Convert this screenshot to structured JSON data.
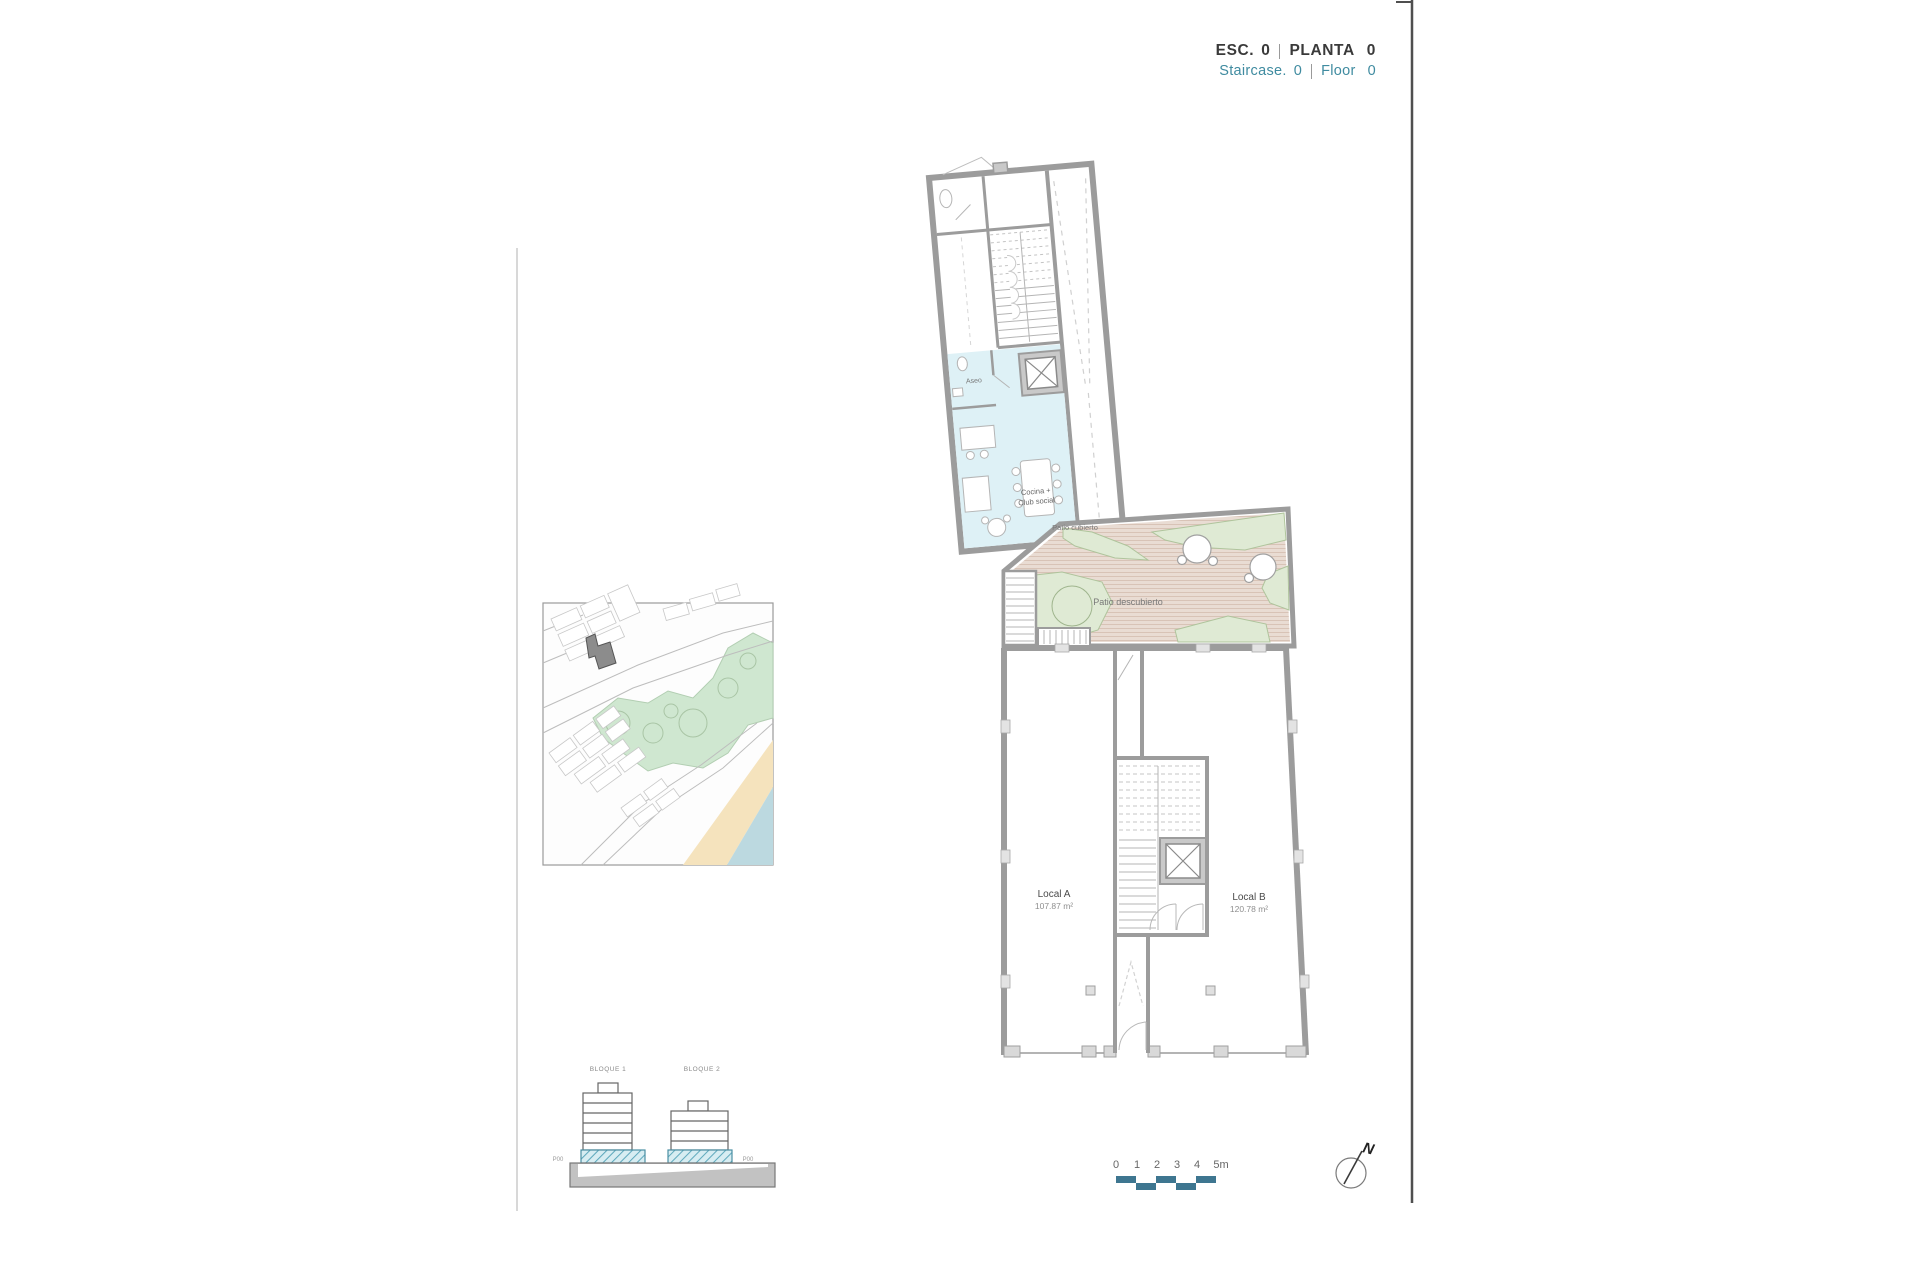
{
  "header": {
    "esc_label": "ESC.",
    "esc_value": "0",
    "planta_label": "PLANTA",
    "planta_value": "0",
    "staircase_label": "Staircase.",
    "staircase_value": "0",
    "floor_label": "Floor",
    "floor_value": "0"
  },
  "plan": {
    "labels": {
      "aseo": "Aseo",
      "cocina_line1": "Cocina +",
      "cocina_line2": "Club social",
      "patio_cubierto": "Patio cubierto",
      "patio_descubierto": "Patio descubierto",
      "local_a_name": "Local A",
      "local_a_area": "107.87 m²",
      "local_b_name": "Local B",
      "local_b_area": "120.78 m²"
    }
  },
  "elevation": {
    "bloque1_label": "BLOQUE 1",
    "bloque2_label": "BLOQUE 2",
    "p00_left": "P00",
    "p00_right": "P00"
  },
  "scalebar": {
    "ticks": [
      "0",
      "1",
      "2",
      "3",
      "4",
      "5m"
    ],
    "color": "#3e7690"
  },
  "compass": {
    "north_label": "N"
  },
  "colors": {
    "accent_teal": "#3f8ba0",
    "text_dark": "#3a3a3a",
    "wall_gray": "#9c9c9c",
    "room_cyan": "#def1f6",
    "patio_tan": "#e9dcd3",
    "patio_green": "#dfead4",
    "map_park_green": "#cfe7d0",
    "map_beach": "#f5e3bd",
    "map_sea": "#bcd9e0",
    "highlight_building": "#8a8a8a",
    "scalebar_teal": "#3e7690"
  }
}
